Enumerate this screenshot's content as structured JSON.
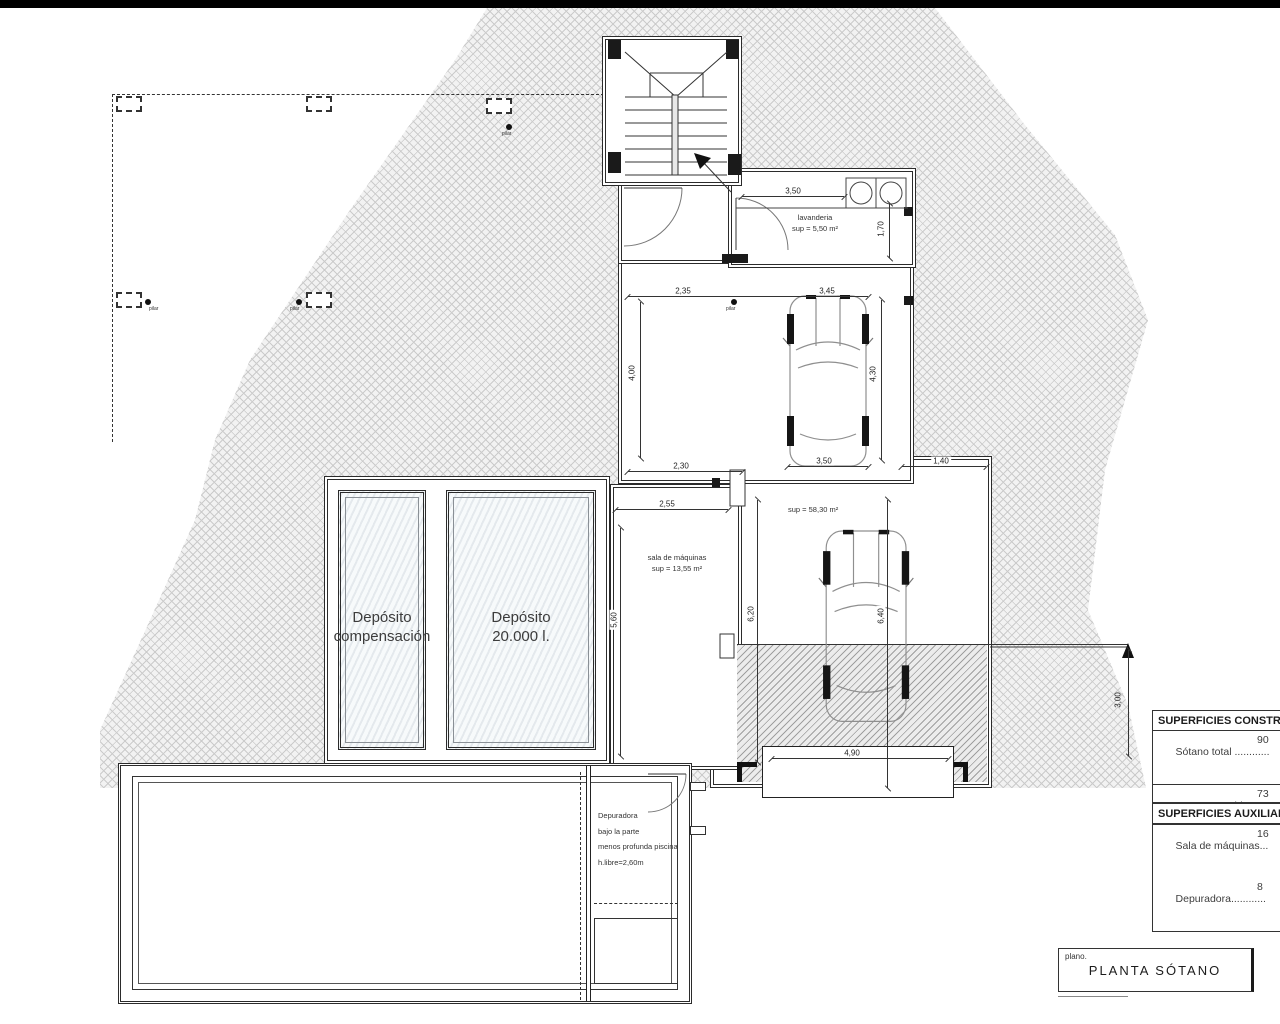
{
  "title_block": {
    "label": "plano.",
    "title": "PLANTA SÓTANO"
  },
  "rooms": {
    "lavanderia": {
      "name": "lavanderia",
      "area": "sup = 5,50 m²"
    },
    "sala_maquinas": {
      "name": "sala de máquinas",
      "area": "sup = 13,55 m²"
    },
    "garaje": {
      "area": "sup = 58,30 m²"
    },
    "deposito_compensacion": {
      "line1": "Depósito",
      "line2": "compensación"
    },
    "deposito_20000": {
      "line1": "Depósito",
      "line2": "20.000 l."
    },
    "depuradora": {
      "line1": "Depuradora",
      "line2": "bajo la parte",
      "line3": "menos profunda piscina",
      "line4": "h.libre=2,60m"
    }
  },
  "dims": {
    "lav_w": "3,50",
    "lav_h": "1,70",
    "hall_w": "2,35",
    "hall_h": "4,00",
    "hall_bw": "2,30",
    "car_w": "3,45",
    "car_h": "4,30",
    "gar_w": "3,50",
    "ext_w": "1,40",
    "sala_w": "2,55",
    "sala_h": "5,60",
    "gar2_h": "6,20",
    "ramp_h": "6,40",
    "ramp_w": "4,90",
    "right_h": "3,00"
  },
  "pilar_label": "pilar",
  "tables": {
    "construidas": {
      "header": "SUPERFICIES CONSTRU",
      "rows": [
        {
          "label": "Sótano total ............",
          "value": "90"
        },
        {
          "label": "NO computable ....",
          "value": "73"
        },
        {
          "label": "COMPUTABLE      ....",
          "value": "16"
        }
      ]
    },
    "auxiliares": {
      "header": "SUPERFICIES AUXILIAR",
      "rows": [
        {
          "label": "Sala de máquinas...",
          "value": "16"
        },
        {
          "label": "Depuradora............",
          "value": "8"
        }
      ]
    }
  },
  "colors": {
    "line": "#2b2b2b",
    "hatch": "#cbcbcb",
    "ramp_hatch": "#9f9f9f"
  }
}
